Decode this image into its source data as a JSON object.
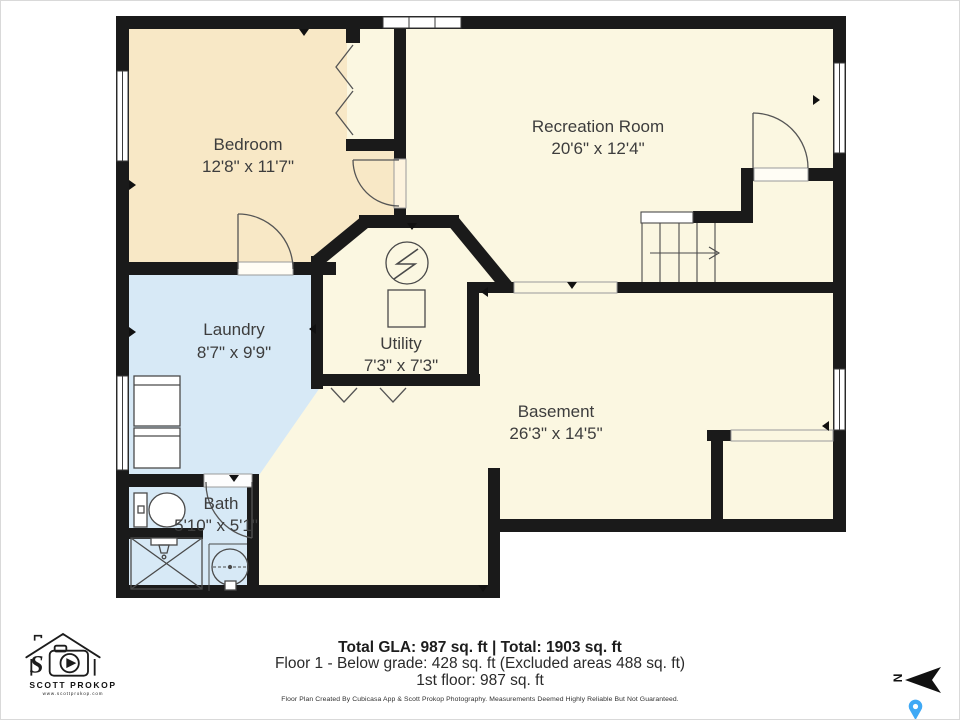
{
  "plan": {
    "rooms": [
      {
        "label": "Bedroom",
        "dims": "12'8\" x 11'7\""
      },
      {
        "label": "Recreation Room",
        "dims": "20'6\" x 12'4\""
      },
      {
        "label": "Laundry",
        "dims": "8'7\" x 9'9\""
      },
      {
        "label": "Utility",
        "dims": "7'3\" x 7'3\""
      },
      {
        "label": "Basement",
        "dims": "26'3\" x 14'5\""
      },
      {
        "label": "Bath",
        "dims": "5'10\" x 5'1\""
      }
    ],
    "compass_label": "N"
  },
  "summary": {
    "totals": "Total GLA: 987 sq. ft | Total: 1903 sq. ft",
    "floor1": "Floor 1 - Below grade: 428 sq. ft (Excluded areas 488 sq. ft)",
    "first_floor": "1st floor: 987 sq. ft",
    "disclaimer": "Floor Plan Created By Cubicasa App & Scott Prokop Photography. Measurements Deemed Highly Reliable But Not Guaranteed."
  },
  "branding": {
    "name": "SCOTT PROKOP",
    "website": "www.scottprokop.com"
  },
  "colors": {
    "wall": "#1a1a1a",
    "room_warm": "#f8e8c6",
    "room_cream": "#fbf7e1",
    "room_wet": "#d7e9f6",
    "label_text": "#3d3d3d",
    "pin_blue": "#3fa9f5"
  }
}
